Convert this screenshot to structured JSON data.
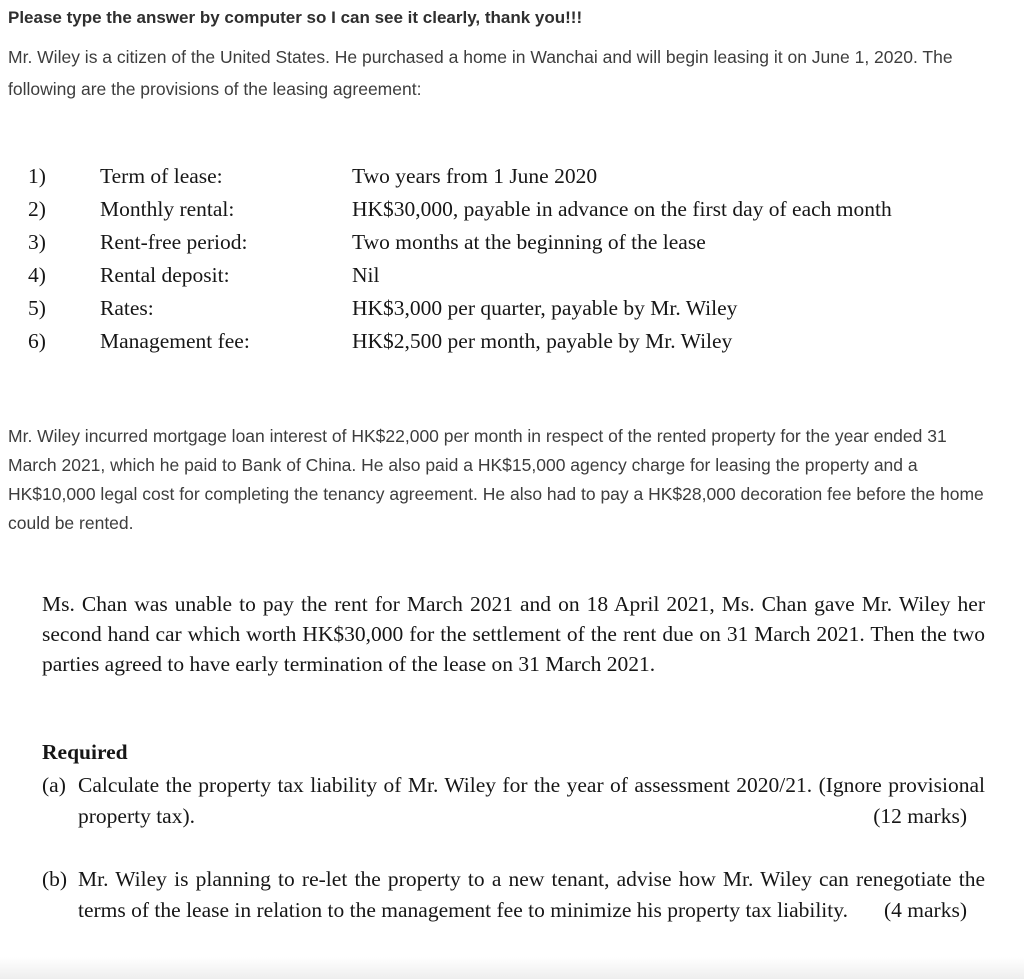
{
  "note": "Please type the answer by computer so I can see it clearly, thank you!!!",
  "intro": "Mr. Wiley is a citizen of the United States. He purchased a home in Wanchai and will begin leasing it on June 1, 2020. The following are the provisions of the leasing agreement:",
  "provisions": {
    "items": [
      {
        "num": "1)",
        "label": "Term of lease:",
        "value": "Two years from 1 June 2020"
      },
      {
        "num": "2)",
        "label": "Monthly rental:",
        "value": "HK$30,000, payable in advance on the first day of each month"
      },
      {
        "num": "3)",
        "label": "Rent-free period:",
        "value": "Two months at the beginning of the lease"
      },
      {
        "num": "4)",
        "label": "Rental deposit:",
        "value": "Nil"
      },
      {
        "num": "5)",
        "label": "Rates:",
        "value": "HK$3,000 per quarter, payable by Mr. Wiley"
      },
      {
        "num": "6)",
        "label": "Management fee:",
        "value": "HK$2,500 per month, payable by Mr. Wiley"
      }
    ]
  },
  "expenses_paragraph": "Mr. Wiley incurred mortgage loan interest of HK$22,000 per month in respect of the rented property for the year ended 31 March 2021, which he paid to Bank of China. He also paid a HK$15,000 agency charge for leasing the property and a HK$10,000 legal cost for completing the tenancy agreement. He also had to pay a HK$28,000 decoration fee before the home could be rented.",
  "chan_paragraph": "Ms. Chan was unable to pay the rent for March 2021 and on 18 April 2021, Ms. Chan gave Mr. Wiley her second hand car which worth HK$30,000 for the settlement of the rent due on 31 March 2021. Then the two parties agreed to have early termination of the lease on 31 March 2021.",
  "required": {
    "heading": "Required",
    "items": [
      {
        "marker": "(a)",
        "text": "Calculate the property tax liability of Mr. Wiley for the year of assessment 2020/21. (Ignore provisional property tax).",
        "marks": "(12 marks)"
      },
      {
        "marker": "(b)",
        "text": "Mr. Wiley is planning to re-let the property to a new tenant, advise how Mr. Wiley can renegotiate the terms of the lease in relation to the management fee to minimize his property tax liability.",
        "marks": "(4 marks)"
      }
    ]
  }
}
